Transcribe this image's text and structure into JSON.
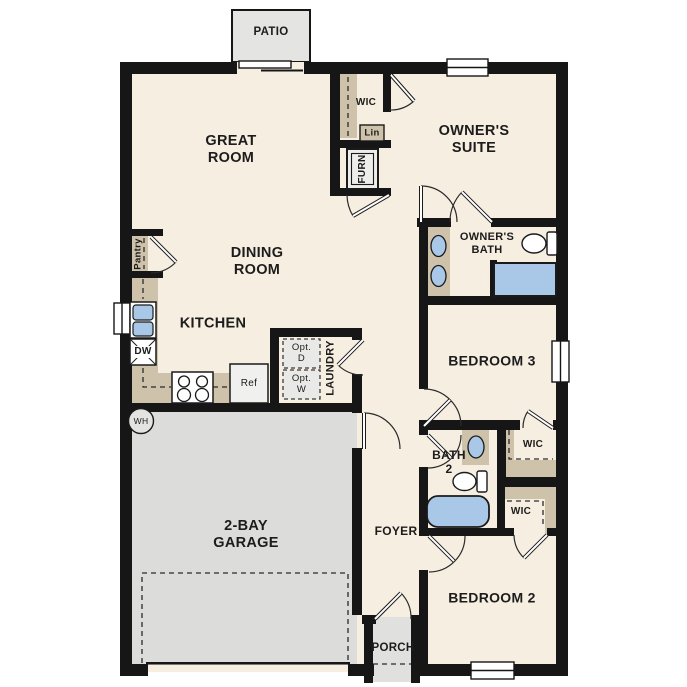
{
  "plan_title": "Single-story floor plan",
  "labels": {
    "patio": "PATIO",
    "great_room": "GREAT ROOM",
    "wic_upper": "WIC",
    "linen": "Lin",
    "furnace": "FURN",
    "owners_suite": "OWNER'S SUITE",
    "pantry": "Pantry",
    "dining_room": "DINING ROOM",
    "owners_bath": "OWNER'S BATH",
    "kitchen": "KITCHEN",
    "dishwasher": "DW",
    "refrigerator": "Ref",
    "opt_dryer": "Opt. D",
    "opt_washer": "Opt. W",
    "laundry": "LAUNDRY",
    "bedroom_3": "BEDROOM 3",
    "water_heater": "WH",
    "bath_2": "BATH 2",
    "wic_bath2": "WIC",
    "wic_bedroom2": "WIC",
    "garage": "2-BAY GARAGE",
    "foyer": "FOYER",
    "bedroom_2": "BEDROOM 2",
    "porch": "PORCH"
  },
  "colors": {
    "floor": "#f6eee1",
    "garage_floor": "#dcdcda",
    "patio_porch": "#e4e4e2",
    "counter_tan": "#cec2aa",
    "fixture_blue": "#a9c7e6",
    "wall": "#161616"
  }
}
